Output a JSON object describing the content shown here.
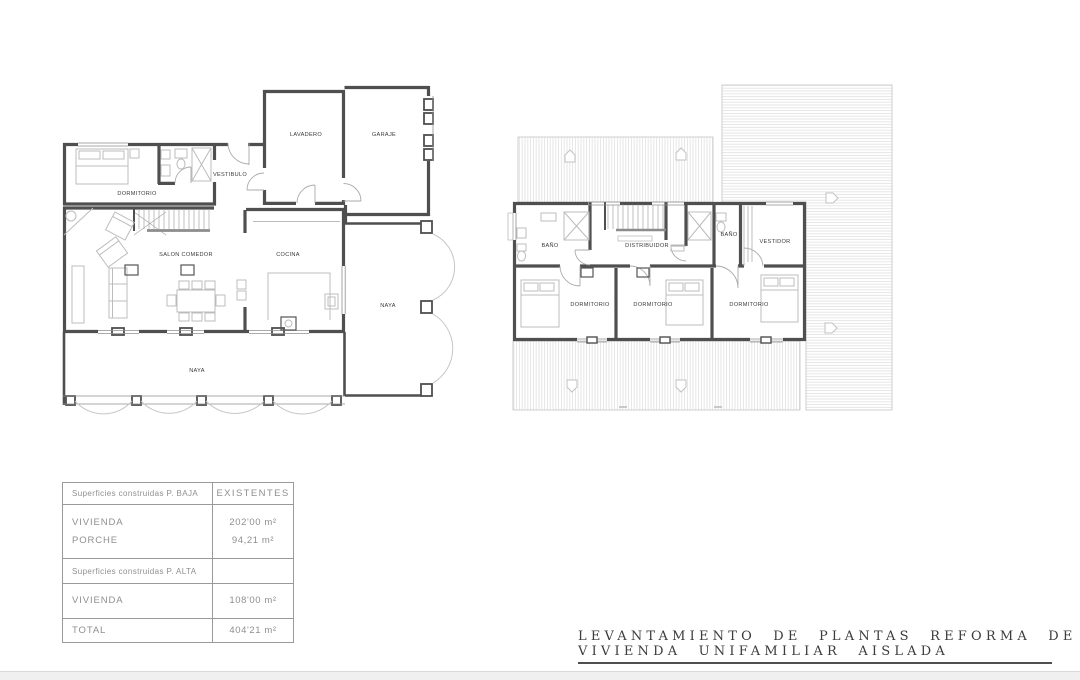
{
  "ground_floor": {
    "rooms": {
      "dormitorio": "DORMITORIO",
      "vestibulo": "VESTIBULO",
      "lavadero": "LAVADERO",
      "garaje": "GARAJE",
      "salon_comedor": "SALON COMEDOR",
      "cocina": "COCINA",
      "naya_lateral": "NAYA",
      "naya_porche": "NAYA"
    }
  },
  "upper_floor": {
    "rooms": {
      "bano_1": "BAÑO",
      "distribuidor": "DISTRIBUIDOR",
      "bano_2": "BAÑO",
      "vestidor": "VESTIDOR",
      "dormitorio_1": "DORMITORIO",
      "dormitorio_2": "DORMITORIO",
      "dormitorio_3": "DORMITORIO"
    }
  },
  "areas_table": {
    "section_baja": {
      "header": "Superficies construidas P. BAJA",
      "header_right": "EXISTENTES",
      "rows": [
        {
          "label": "VIVIENDA",
          "value": "202'00 m²"
        },
        {
          "label": "PORCHE",
          "value": "94,21 m²"
        }
      ]
    },
    "section_alta": {
      "header": "Superficies construidas P. ALTA",
      "rows": [
        {
          "label": "VIVIENDA",
          "value": "108'00 m²"
        }
      ]
    },
    "total_row": {
      "label": "TOTAL",
      "value": "404'21 m²"
    }
  },
  "title_block": {
    "line1": "LEVANTAMIENTO DE PLANTAS REFORMA DE",
    "line2": "VIVIENDA UNIFAMILIAR AISLADA"
  },
  "colors": {
    "wall": "#4f4f4f",
    "furniture": "#bcbcbc",
    "roof_hatch": "#d6d6d6",
    "plan_label": "#3a3a3a",
    "table_text": "#8f8f8f",
    "title_text": "#3b3b3b"
  }
}
